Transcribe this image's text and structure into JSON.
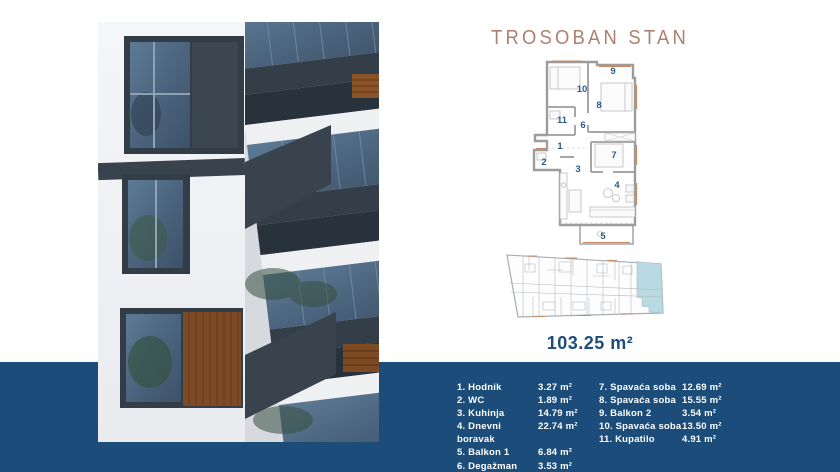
{
  "title": "TROSOBAN STAN",
  "total_area": "103.25 m²",
  "colors": {
    "band": "#1b4c7a",
    "title": "#ae8071",
    "room_number_blue": "#2b5c8e",
    "total_area_blue": "#1d4d7c",
    "site_highlight": "#b9d9e3",
    "plan_wall_gray": "#9c9c9c",
    "plan_accent_orange": "#c9875f"
  },
  "floor_plan": {
    "labels": [
      {
        "n": "1",
        "x": 60,
        "y": 92
      },
      {
        "n": "2",
        "x": 44,
        "y": 108
      },
      {
        "n": "3",
        "x": 78,
        "y": 115
      },
      {
        "n": "4",
        "x": 117,
        "y": 131
      },
      {
        "n": "5",
        "x": 103,
        "y": 182
      },
      {
        "n": "6",
        "x": 83,
        "y": 71
      },
      {
        "n": "7",
        "x": 114,
        "y": 101
      },
      {
        "n": "8",
        "x": 99,
        "y": 51
      },
      {
        "n": "9",
        "x": 113,
        "y": 17
      },
      {
        "n": "10",
        "x": 82,
        "y": 35
      },
      {
        "n": "11",
        "x": 62,
        "y": 66
      }
    ]
  },
  "legend": {
    "left": [
      {
        "name": "1. Hodnik",
        "area": "3.27 m²"
      },
      {
        "name": "2. WC",
        "area": "1.89 m²"
      },
      {
        "name": "3. Kuhinja",
        "area": "14.79 m²"
      },
      {
        "name": "4. Dnevni boravak",
        "area": "22.74 m²"
      },
      {
        "name": "5. Balkon 1",
        "area": "6.84 m²"
      },
      {
        "name": "6. Degažman",
        "area": "3.53 m²"
      }
    ],
    "right": [
      {
        "name": "7. Spavaća soba",
        "area": "12.69 m²"
      },
      {
        "name": "8. Spavaća soba",
        "area": "15.55 m²"
      },
      {
        "name": "9. Balkon 2",
        "area": "3.54 m²"
      },
      {
        "name": "10. Spavaća soba",
        "area": "13.50 m²"
      },
      {
        "name": "11. Kupatilo",
        "area": "4.91 m²"
      }
    ]
  }
}
